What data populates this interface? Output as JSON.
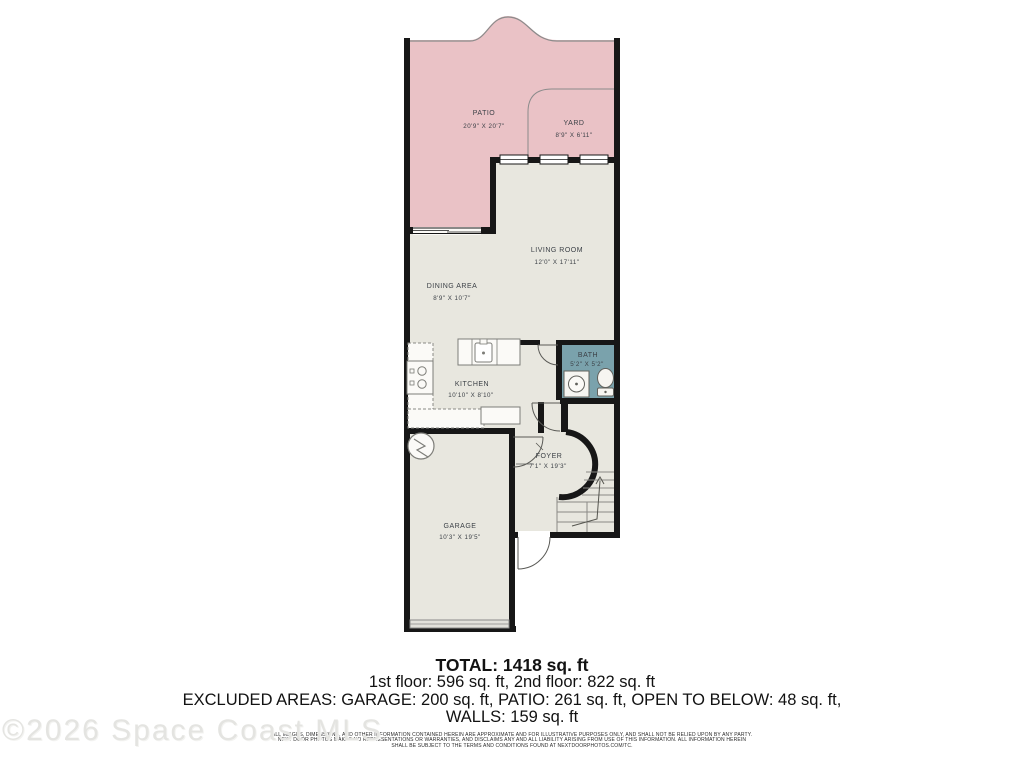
{
  "floor_plan": {
    "rooms": [
      {
        "name": "PATIO",
        "dims": "20'9\" X 20'7\""
      },
      {
        "name": "YARD",
        "dims": "8'9\" X 6'11\""
      },
      {
        "name": "LIVING ROOM",
        "dims": "12'0\" X 17'11\""
      },
      {
        "name": "DINING AREA",
        "dims": "8'9\" X 10'7\""
      },
      {
        "name": "KITCHEN",
        "dims": "10'10\" X 8'10\""
      },
      {
        "name": "BATH",
        "dims": "5'2\" X 5'2\""
      },
      {
        "name": "FOYER",
        "dims": "7'1\" X 19'3\""
      },
      {
        "name": "GARAGE",
        "dims": "10'3\" X 19'5\""
      }
    ],
    "colors": {
      "patio_fill": "#eac2c6",
      "interior_fill": "#e8e7df",
      "bath_fill": "#7aa2ac",
      "wall": "#171717",
      "fixture_stroke": "#7d7d78"
    }
  },
  "summary": {
    "total": "TOTAL: 1418 sq. ft",
    "floors": "1st floor: 596 sq. ft, 2nd floor: 822 sq. ft",
    "excluded": "EXCLUDED AREAS: GARAGE: 200 sq. ft, PATIO: 261 sq. ft, OPEN TO BELOW: 48 sq. ft,",
    "walls": "WALLS: 159 sq. ft"
  },
  "disclaimer": {
    "line1": "ALL IMAGES, DIMENSIONS, AND OTHER INFORMATION CONTAINED HEREIN ARE APPROXIMATE AND FOR ILLUSTRATIVE PURPOSES ONLY, AND SHALL NOT BE RELIED UPON BY ANY PARTY.",
    "line2": "NEXT DOOR PHOTOS MAKES NO REPRESENTATIONS OR WARRANTIES, AND DISCLAIMS ANY AND ALL LIABILITY ARISING FROM USE OF THIS INFORMATION. ALL INFORMATION HEREIN",
    "line3": "SHALL BE SUBJECT TO THE TERMS AND CONDITIONS FOUND AT NEXTDOORPHOTOS.COM/TC."
  },
  "watermark": "©2026 Space Coast MLS"
}
